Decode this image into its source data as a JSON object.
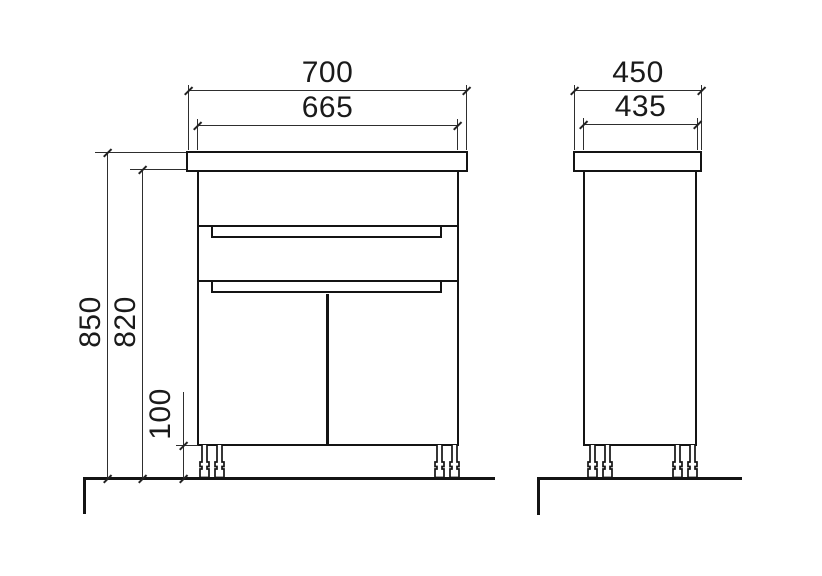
{
  "drawing": {
    "type": "cabinet technical drawing, front and side elevation",
    "line_color": "#141414",
    "background": "#ffffff"
  },
  "dimensions": {
    "front_width_top": "700",
    "front_width_body": "665",
    "height_total": "850",
    "height_under_top": "820",
    "plinth_height": "100",
    "side_depth_top": "450",
    "side_depth_body": "435"
  }
}
